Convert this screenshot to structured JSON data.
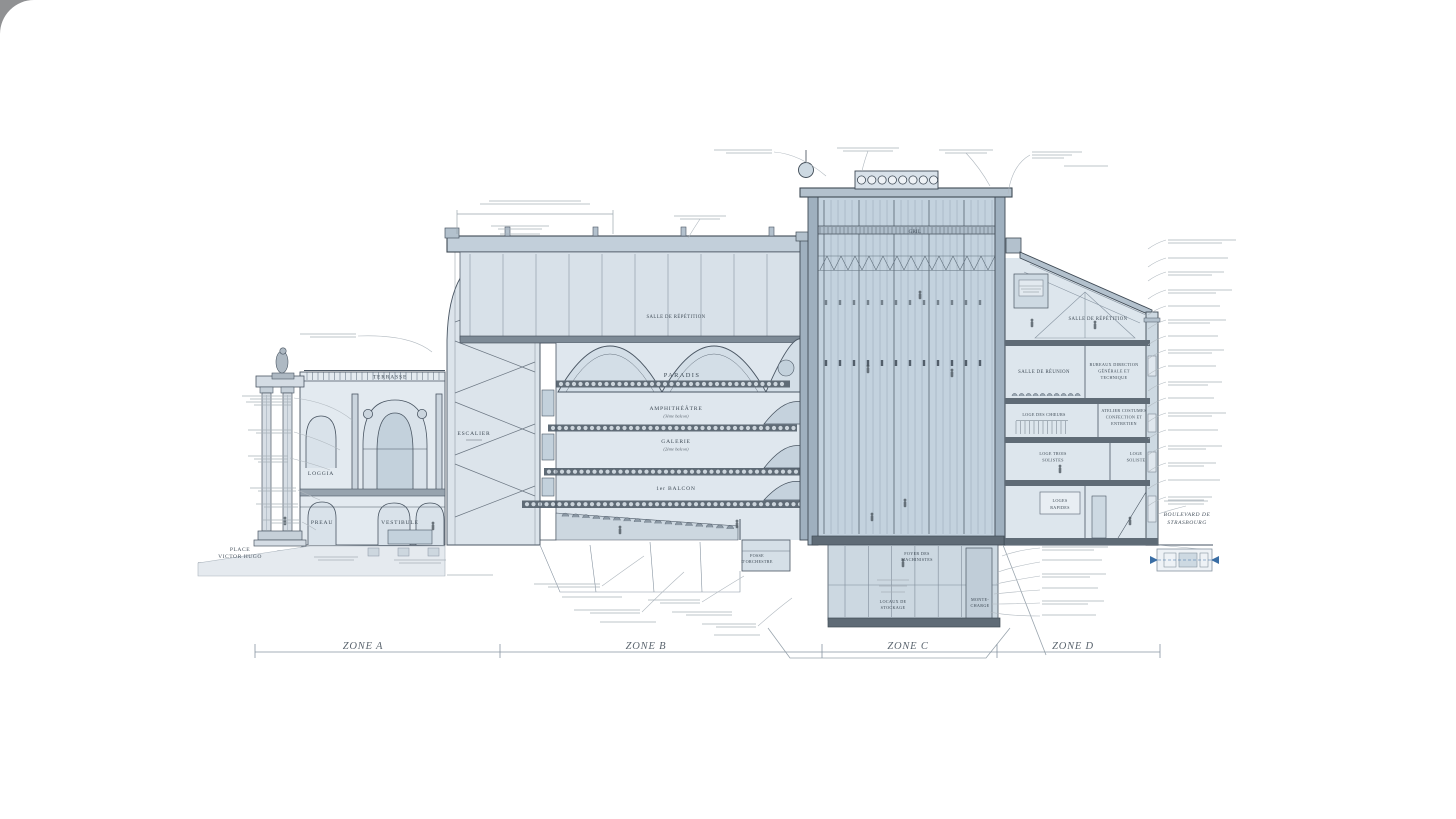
{
  "page": {
    "background": "#ffffff"
  },
  "colors": {
    "line": "#4a5663",
    "line_light": "#8794a1",
    "fill_light": "#e2e9ef",
    "fill_mid": "#cfdae3",
    "fill_blue": "#bccbd8",
    "slab": "#5f6b76",
    "annotation": "#9aa5ae",
    "plan_arrow_blue": "#3a6ea5"
  },
  "zone_scale": {
    "a": "ZONE A",
    "b": "ZONE B",
    "c": "ZONE C",
    "d": "ZONE D"
  },
  "streets": {
    "left_line1": "PLACE",
    "left_line2": "VICTOR HUGO",
    "right_line1": "BOULEVARD DE",
    "right_line2": "STRASBOURG"
  },
  "zone_a": {
    "terrasse": "TERRASSE",
    "loggia": "LOGGIA",
    "preau": "PREAU",
    "vestibule": "VESTIBULE",
    "escalier": "ESCALIER"
  },
  "auditorium": {
    "salle_repetition": "SALLE DE RÉPÉTITION",
    "paradis": "PARADIS",
    "amphitheatre": "AMPHITHÉÂTRE",
    "amphitheatre_sub": "(3ème balcon)",
    "galerie": "GALERIE",
    "galerie_sub": "(2ème balcon)",
    "premier_balcon": "1er BALCON",
    "fosse_line1": "FOSSE",
    "fosse_line2": "D'ORCHESTRE"
  },
  "stage": {
    "gril": "GRIL",
    "foyer_line1": "FOYER DES",
    "foyer_line2": "MACHINISTES",
    "stockage_line1": "LOCAUX DE",
    "stockage_line2": "STOCKAGE",
    "monte_line1": "MONTE-",
    "monte_line2": "CHARGE"
  },
  "zone_d": {
    "salle_repetition": "SALLE DE RÉPÉTITION",
    "salle_reunion": "SALLE DE RÉUNION",
    "bureaux_line1": "BUREAUX DIRECTION",
    "bureaux_line2": "GÉNÉRALE ET",
    "bureaux_line3": "TECHNIQUE",
    "loge_choeurs": "LOGE DES CHŒURS",
    "atelier_line1": "ATELIER COSTUMES",
    "atelier_line2": "CONFECTION ET",
    "atelier_line3": "ENTRETIEN",
    "loge_trois_line1": "LOGE TROIS",
    "loge_trois_line2": "SOLISTES",
    "loge_soliste_line1": "LOGE",
    "loge_soliste_line2": "SOLISTE",
    "loges_rapides_line1": "LOGES",
    "loges_rapides_line2": "RAPIDES"
  }
}
